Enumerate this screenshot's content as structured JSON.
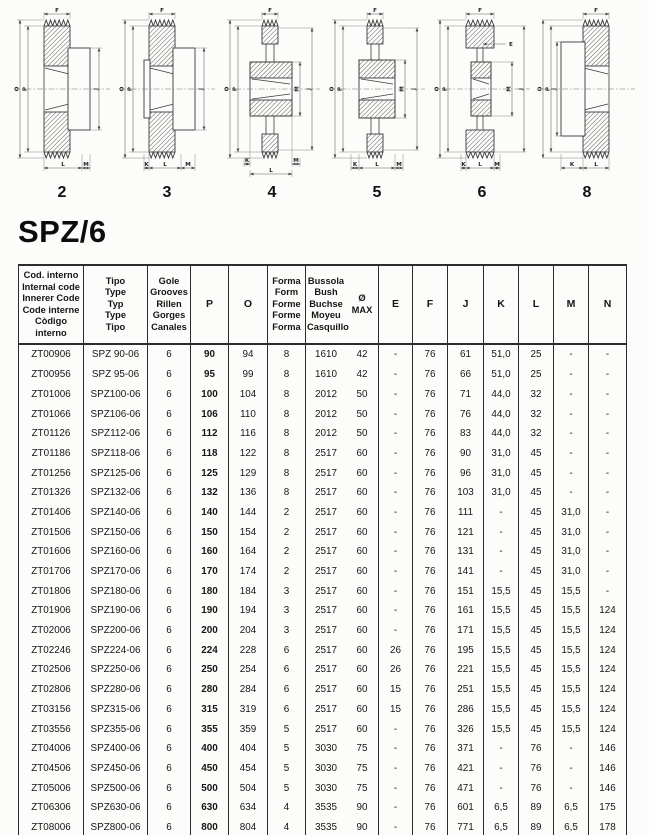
{
  "heading": "SPZ/6",
  "diagrams": [
    {
      "number": "2",
      "dims": {
        "top": "F",
        "left": [
          "O",
          "P"
        ],
        "right": [
          "J"
        ],
        "bottom": [
          "L",
          "M"
        ]
      }
    },
    {
      "number": "3",
      "dims": {
        "top": "F",
        "left": [
          "O",
          "P"
        ],
        "right": [
          "J"
        ],
        "bottom": [
          "K",
          "L",
          "M"
        ]
      }
    },
    {
      "number": "4",
      "dims": {
        "top": "F",
        "left": [
          "O",
          "P"
        ],
        "right": [
          "M",
          "J"
        ],
        "bottom": [
          "K",
          "L",
          "M"
        ]
      }
    },
    {
      "number": "5",
      "dims": {
        "top": "F",
        "left": [
          "O",
          "P"
        ],
        "right": [
          "M",
          "J"
        ],
        "bottom": [
          "K",
          "L",
          "M"
        ]
      }
    },
    {
      "number": "6",
      "dims": {
        "top": "F",
        "left": [
          "O",
          "P"
        ],
        "right": [
          "M",
          "J"
        ],
        "extra": "E",
        "bottom": [
          "K",
          "L",
          "M"
        ]
      }
    },
    {
      "number": "8",
      "dims": {
        "top": "F",
        "left": [
          "O",
          "P",
          "J"
        ],
        "right": [],
        "bottom": [
          "K",
          "L"
        ]
      }
    }
  ],
  "table": {
    "column_headers": [
      {
        "lines": [
          "Cod. interno",
          "Internal code",
          "Innerer Code",
          "Code interne",
          "Còdigo interno"
        ]
      },
      {
        "lines": [
          "Tipo",
          "Type",
          "Typ",
          "Type",
          "Tipo"
        ]
      },
      {
        "lines": [
          "Gole",
          "Grooves",
          "Rillen",
          "Gorges",
          "Canales"
        ]
      },
      {
        "lines": [
          "P"
        ]
      },
      {
        "lines": [
          "O"
        ]
      },
      {
        "lines": [
          "Forma",
          "Form",
          "Forme",
          "Forme",
          "Forma"
        ]
      },
      {
        "lines": [
          "Bussola",
          "Bush",
          "Buchse",
          "Moyeu",
          "Casquillo"
        ]
      },
      {
        "lines": [
          "Ø",
          "MAX"
        ]
      },
      {
        "lines": [
          "E"
        ]
      },
      {
        "lines": [
          "F"
        ]
      },
      {
        "lines": [
          "J"
        ]
      },
      {
        "lines": [
          "K"
        ]
      },
      {
        "lines": [
          "L"
        ]
      },
      {
        "lines": [
          "M"
        ]
      },
      {
        "lines": [
          "N"
        ]
      }
    ],
    "rows": [
      [
        "ZT00906",
        "SPZ 90-06",
        "6",
        "90",
        "94",
        "8",
        "1610",
        "42",
        "-",
        "76",
        "61",
        "51,0",
        "25",
        "-",
        "-"
      ],
      [
        "ZT00956",
        "SPZ 95-06",
        "6",
        "95",
        "99",
        "8",
        "1610",
        "42",
        "-",
        "76",
        "66",
        "51,0",
        "25",
        "-",
        "-"
      ],
      [
        "ZT01006",
        "SPZ100-06",
        "6",
        "100",
        "104",
        "8",
        "2012",
        "50",
        "-",
        "76",
        "71",
        "44,0",
        "32",
        "-",
        "-"
      ],
      [
        "ZT01066",
        "SPZ106-06",
        "6",
        "106",
        "110",
        "8",
        "2012",
        "50",
        "-",
        "76",
        "76",
        "44,0",
        "32",
        "-",
        "-"
      ],
      [
        "ZT01126",
        "SPZ112-06",
        "6",
        "112",
        "116",
        "8",
        "2012",
        "50",
        "-",
        "76",
        "83",
        "44,0",
        "32",
        "-",
        "-"
      ],
      [
        "ZT01186",
        "SPZ118-06",
        "6",
        "118",
        "122",
        "8",
        "2517",
        "60",
        "-",
        "76",
        "90",
        "31,0",
        "45",
        "-",
        "-"
      ],
      [
        "ZT01256",
        "SPZ125-06",
        "6",
        "125",
        "129",
        "8",
        "2517",
        "60",
        "-",
        "76",
        "96",
        "31,0",
        "45",
        "-",
        "-"
      ],
      [
        "ZT01326",
        "SPZ132-06",
        "6",
        "132",
        "136",
        "8",
        "2517",
        "60",
        "-",
        "76",
        "103",
        "31,0",
        "45",
        "-",
        "-"
      ],
      [
        "ZT01406",
        "SPZ140-06",
        "6",
        "140",
        "144",
        "2",
        "2517",
        "60",
        "-",
        "76",
        "111",
        "-",
        "45",
        "31,0",
        "-"
      ],
      [
        "ZT01506",
        "SPZ150-06",
        "6",
        "150",
        "154",
        "2",
        "2517",
        "60",
        "-",
        "76",
        "121",
        "-",
        "45",
        "31,0",
        "-"
      ],
      [
        "ZT01606",
        "SPZ160-06",
        "6",
        "160",
        "164",
        "2",
        "2517",
        "60",
        "-",
        "76",
        "131",
        "-",
        "45",
        "31,0",
        "-"
      ],
      [
        "ZT01706",
        "SPZ170-06",
        "6",
        "170",
        "174",
        "2",
        "2517",
        "60",
        "-",
        "76",
        "141",
        "-",
        "45",
        "31,0",
        "-"
      ],
      [
        "ZT01806",
        "SPZ180-06",
        "6",
        "180",
        "184",
        "3",
        "2517",
        "60",
        "-",
        "76",
        "151",
        "15,5",
        "45",
        "15,5",
        "-"
      ],
      [
        "ZT01906",
        "SPZ190-06",
        "6",
        "190",
        "194",
        "3",
        "2517",
        "60",
        "-",
        "76",
        "161",
        "15,5",
        "45",
        "15,5",
        "124"
      ],
      [
        "ZT02006",
        "SPZ200-06",
        "6",
        "200",
        "204",
        "3",
        "2517",
        "60",
        "-",
        "76",
        "171",
        "15,5",
        "45",
        "15,5",
        "124"
      ],
      [
        "ZT02246",
        "SPZ224-06",
        "6",
        "224",
        "228",
        "6",
        "2517",
        "60",
        "26",
        "76",
        "195",
        "15,5",
        "45",
        "15,5",
        "124"
      ],
      [
        "ZT02506",
        "SPZ250-06",
        "6",
        "250",
        "254",
        "6",
        "2517",
        "60",
        "26",
        "76",
        "221",
        "15,5",
        "45",
        "15,5",
        "124"
      ],
      [
        "ZT02806",
        "SPZ280-06",
        "6",
        "280",
        "284",
        "6",
        "2517",
        "60",
        "15",
        "76",
        "251",
        "15,5",
        "45",
        "15,5",
        "124"
      ],
      [
        "ZT03156",
        "SPZ315-06",
        "6",
        "315",
        "319",
        "6",
        "2517",
        "60",
        "15",
        "76",
        "286",
        "15,5",
        "45",
        "15,5",
        "124"
      ],
      [
        "ZT03556",
        "SPZ355-06",
        "6",
        "355",
        "359",
        "5",
        "2517",
        "60",
        "-",
        "76",
        "326",
        "15,5",
        "45",
        "15,5",
        "124"
      ],
      [
        "ZT04006",
        "SPZ400-06",
        "6",
        "400",
        "404",
        "5",
        "3030",
        "75",
        "-",
        "76",
        "371",
        "-",
        "76",
        "-",
        "146"
      ],
      [
        "ZT04506",
        "SPZ450-06",
        "6",
        "450",
        "454",
        "5",
        "3030",
        "75",
        "-",
        "76",
        "421",
        "-",
        "76",
        "-",
        "146"
      ],
      [
        "ZT05006",
        "SPZ500-06",
        "6",
        "500",
        "504",
        "5",
        "3030",
        "75",
        "-",
        "76",
        "471",
        "-",
        "76",
        "-",
        "146"
      ],
      [
        "ZT06306",
        "SPZ630-06",
        "6",
        "630",
        "634",
        "4",
        "3535",
        "90",
        "-",
        "76",
        "601",
        "6,5",
        "89",
        "6,5",
        "175"
      ],
      [
        "ZT08006",
        "SPZ800-06",
        "6",
        "800",
        "804",
        "4",
        "3535",
        "90",
        "-",
        "76",
        "771",
        "6,5",
        "89",
        "6,5",
        "178"
      ]
    ]
  }
}
